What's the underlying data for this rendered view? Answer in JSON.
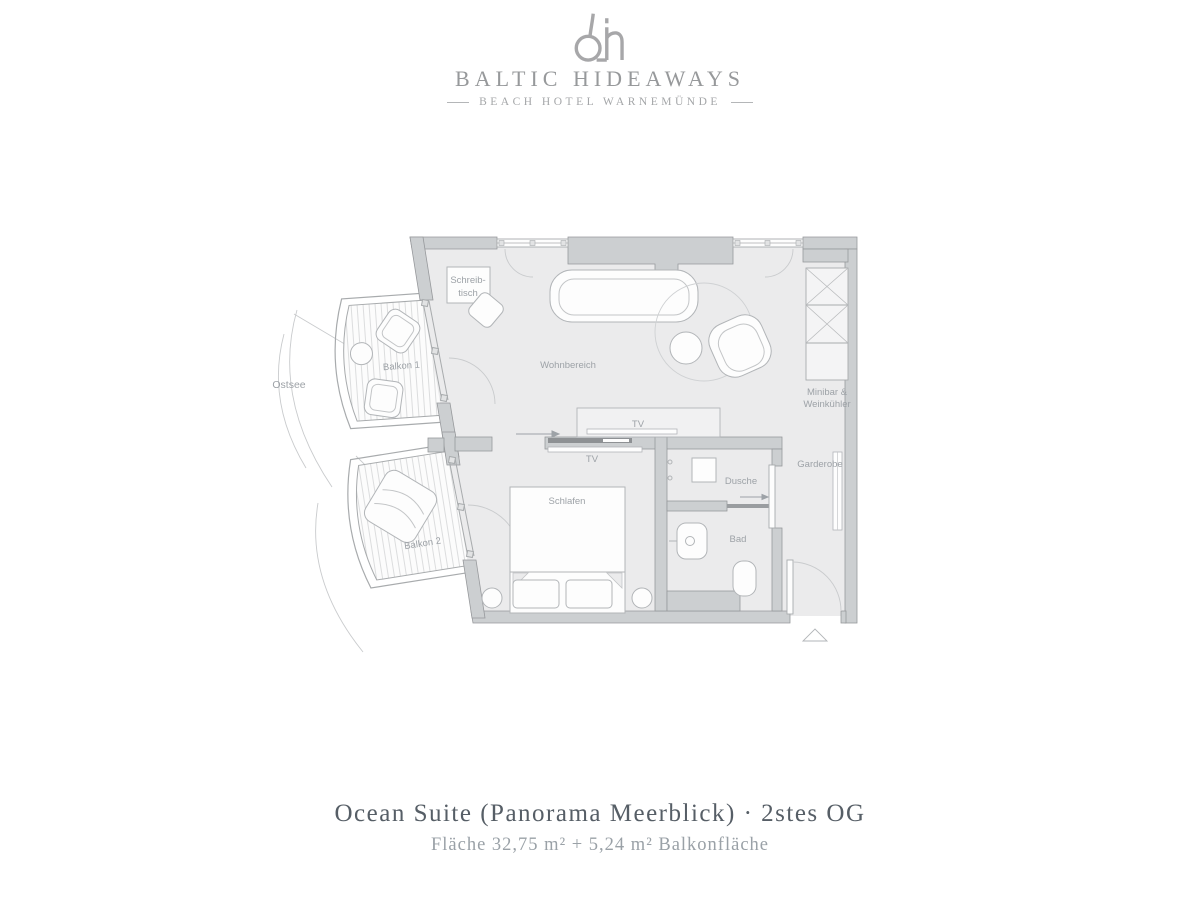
{
  "header": {
    "monogram": "bh",
    "brand": "BALTIC HIDEAWAYS",
    "tagline": "BEACH HOTEL WARNEMÜNDE"
  },
  "plan": {
    "labels": {
      "ostsee": "Ostsee",
      "balkon1": "Balkon 1",
      "balkon2": "Balkon 2",
      "schreibtisch1": "Schreib-",
      "schreibtisch2": "tisch",
      "wohnbereich": "Wohnbereich",
      "tv_living": "TV",
      "tv_bedroom": "TV",
      "schlafen": "Schlafen",
      "dusche": "Dusche",
      "bad": "Bad",
      "garderobe": "Garderobe",
      "minibar1": "Minibar &",
      "minibar2": "Weinkühler"
    },
    "colors": {
      "wall": "#cccfd1",
      "wall_stroke": "#97999c",
      "floor": "#ebebec",
      "label": "#9da2a7",
      "furniture_stroke": "#b2b5b8"
    }
  },
  "footer": {
    "title": "Ocean Suite (Panorama Meerblick) · 2stes OG",
    "subtitle": "Fläche 32,75 m² + 5,24 m² Balkonfläche"
  }
}
